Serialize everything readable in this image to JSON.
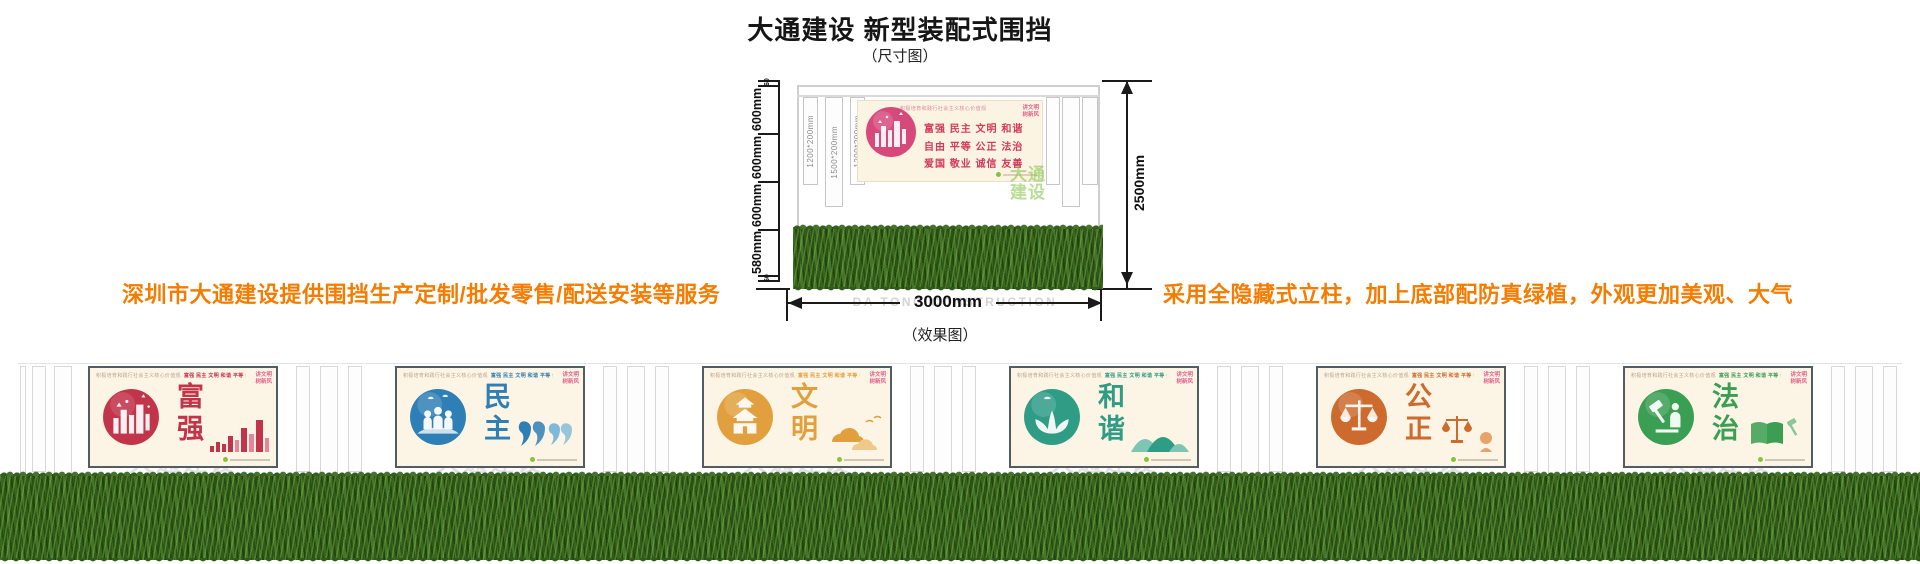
{
  "page": {
    "title": "大通建设 新型装配式围挡",
    "dim_label": "（尺寸图）",
    "effect_label": "（效果图）",
    "left_note": "深圳市大通建设提供围挡生产定制/批发零售/配送安装等服务",
    "right_note": "采用全隐藏式立柱，加上底部配防真绿植，外观更加美观、大气",
    "note_color": "#f57c00"
  },
  "watermark": {
    "cn": "大通建设",
    "en": "DA TONG CONSTRUCTION"
  },
  "diagram": {
    "ruler": {
      "top_small": "60",
      "segments": [
        "600mm",
        "600mm",
        "600mm",
        "580mm"
      ],
      "bottom_small": "60"
    },
    "posts": [
      "1200*200mm",
      "1500*200mm",
      "1200*200mm"
    ],
    "height_dim": "2500mm",
    "width_dim": "3000mm",
    "green_watermark_line1": "大通",
    "green_watermark_line2": "建设",
    "poster": {
      "header": "积极培育和践行社会主义核心价值观",
      "badge_line1": "讲文明",
      "badge_line2": "树新风",
      "rows": [
        "富强 民主 文明 和谐",
        "自由 平等 公正 法治",
        "爱国 敬业 诚信 友善"
      ]
    }
  },
  "effect": {
    "header_prefix": "积极培育和践行社会主义核心价值观",
    "header_values": "富强 民主 文明 和谐 平等 公正 法治 爱国 敬业 诚信 友善",
    "badge_line1": "讲文明",
    "badge_line2": "树新风",
    "posters": [
      {
        "name": "fuqiang",
        "word": "富强",
        "color": "#c2344a",
        "color2": "#e58798"
      },
      {
        "name": "minzhu",
        "word": "民主",
        "color": "#2e7fb5",
        "color2": "#7db9d8"
      },
      {
        "name": "wenming",
        "word": "文明",
        "color": "#e1a03d",
        "color2": "#efc98a"
      },
      {
        "name": "hexie",
        "word": "和谐",
        "color": "#2f9c86",
        "color2": "#7cc6b3"
      },
      {
        "name": "gongzheng",
        "word": "公正",
        "color": "#cd6a2d",
        "color2": "#e8a36b"
      },
      {
        "name": "fazhi",
        "word": "法治",
        "color": "#3a9e53",
        "color2": "#8cc79a"
      }
    ],
    "colors": {
      "grass": "#2f5a1d",
      "poster_bg": "#fcf4e4",
      "watermark_gray": "#d8d8d8"
    }
  }
}
